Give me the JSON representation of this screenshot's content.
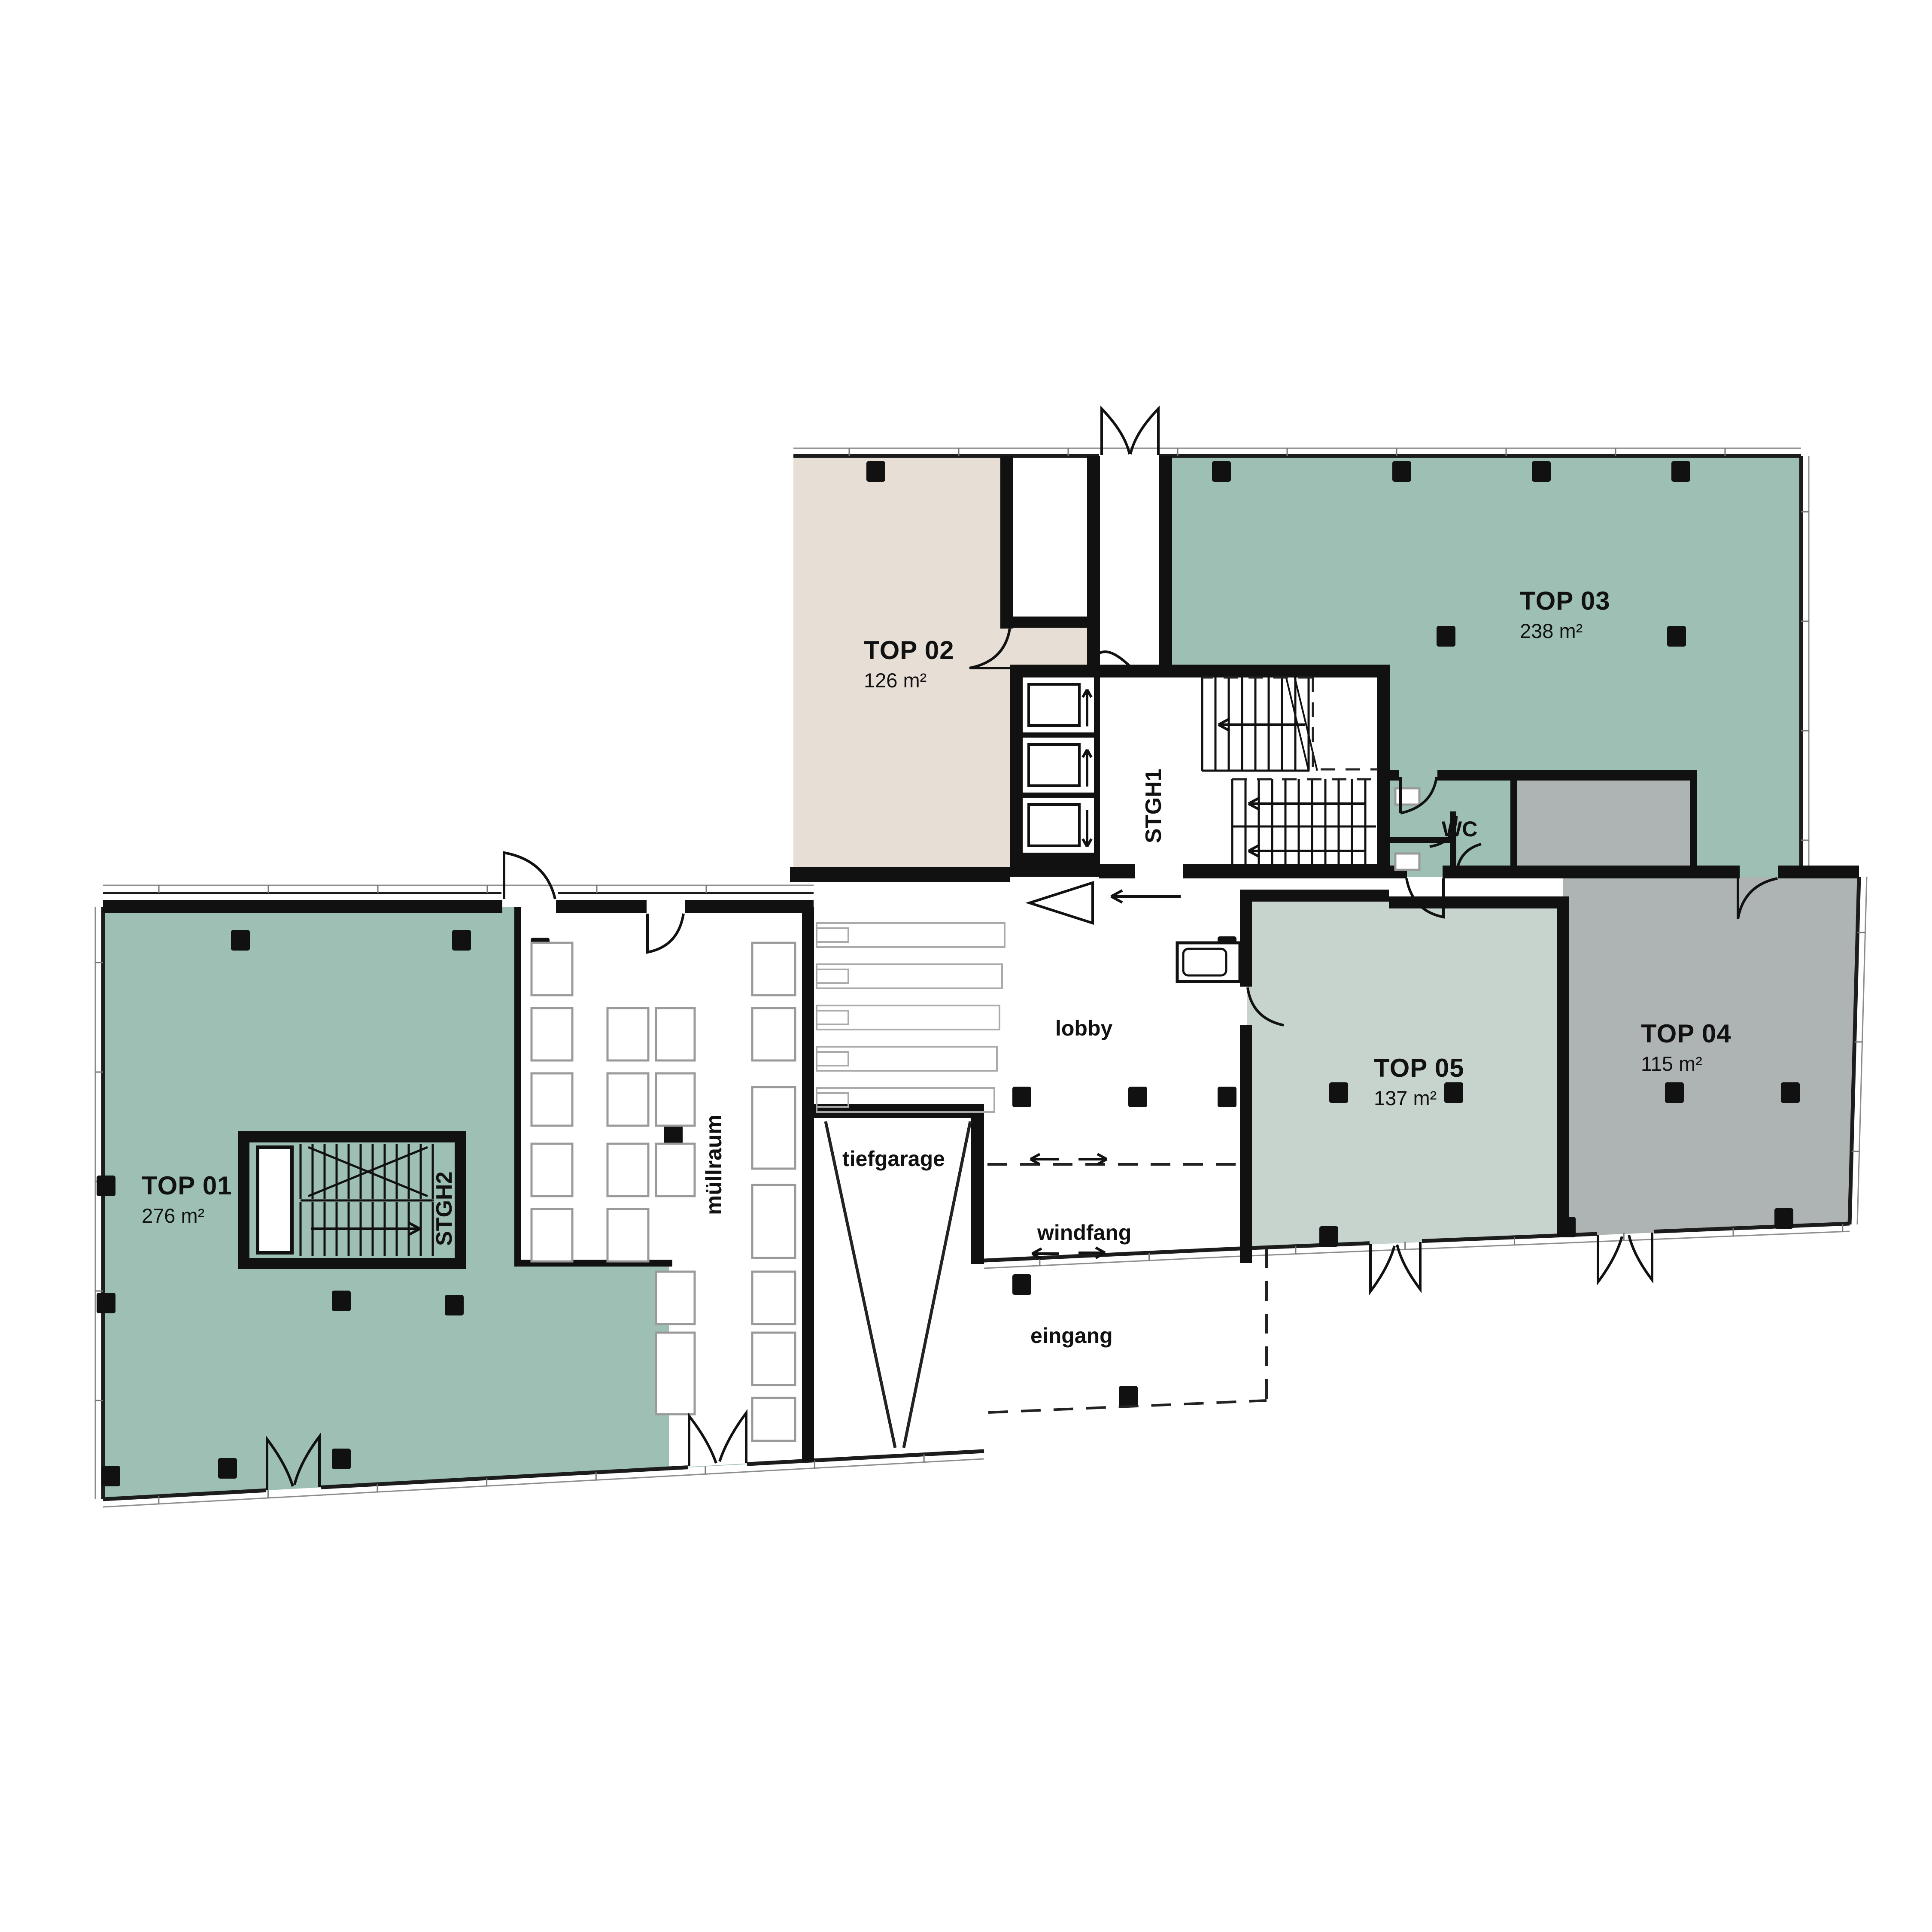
{
  "plan": {
    "units": [
      {
        "id": "top01",
        "label": "TOP 01",
        "area": "276 m²"
      },
      {
        "id": "top02",
        "label": "TOP 02",
        "area": "126 m²"
      },
      {
        "id": "top03",
        "label": "TOP 03",
        "area": "238 m²"
      },
      {
        "id": "top04",
        "label": "TOP 04",
        "area": "115 m²"
      },
      {
        "id": "top05",
        "label": "TOP 05",
        "area": "137 m²"
      }
    ],
    "rooms": {
      "lobby": "lobby",
      "windfang": "windfang",
      "eingang": "eingang",
      "tiefgarage": "tiefgarage",
      "wc": "WC",
      "stairwell_1": "STGH1",
      "stairwell_2": "STGH2",
      "trash_room": "müllraum"
    },
    "colors": {
      "unit_green": "#9dbfb4",
      "unit_sage": "#c7d3cd",
      "unit_gray": "#aeb4b3",
      "unit_beige": "#e7dfd5",
      "wall": "#111111",
      "glass": "#8d8d8d",
      "background": "#ffffff"
    }
  }
}
